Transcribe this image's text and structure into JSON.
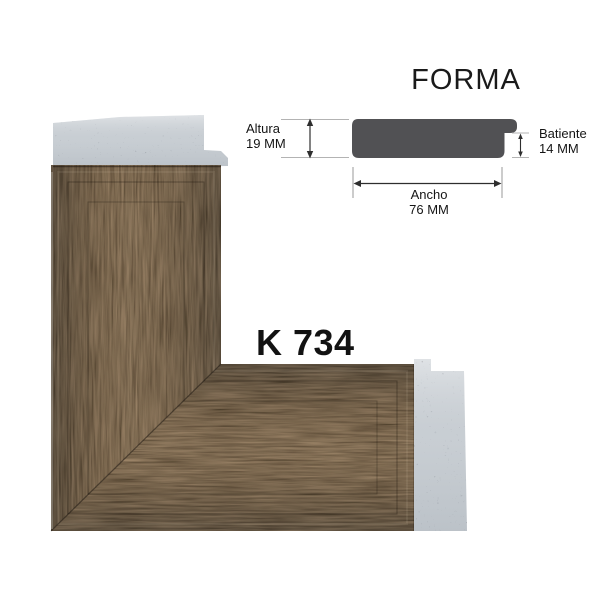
{
  "title": "FORMA",
  "product_code": "K 734",
  "profile_diagram": {
    "altura": {
      "label": "Altura",
      "value": "19 MM"
    },
    "batiente": {
      "label": "Batiente",
      "value": "14 MM"
    },
    "ancho": {
      "label": "Ancho",
      "value": "76 MM"
    }
  },
  "colors": {
    "profile_shape": "#515154",
    "edge_gray": "#ced3d8",
    "wood_base": "#271b10",
    "wood_grain": "#5c4329",
    "text": "#1a1a1a",
    "dim_line": "#2e2e2e",
    "ext_line": "#b3b3b3"
  }
}
